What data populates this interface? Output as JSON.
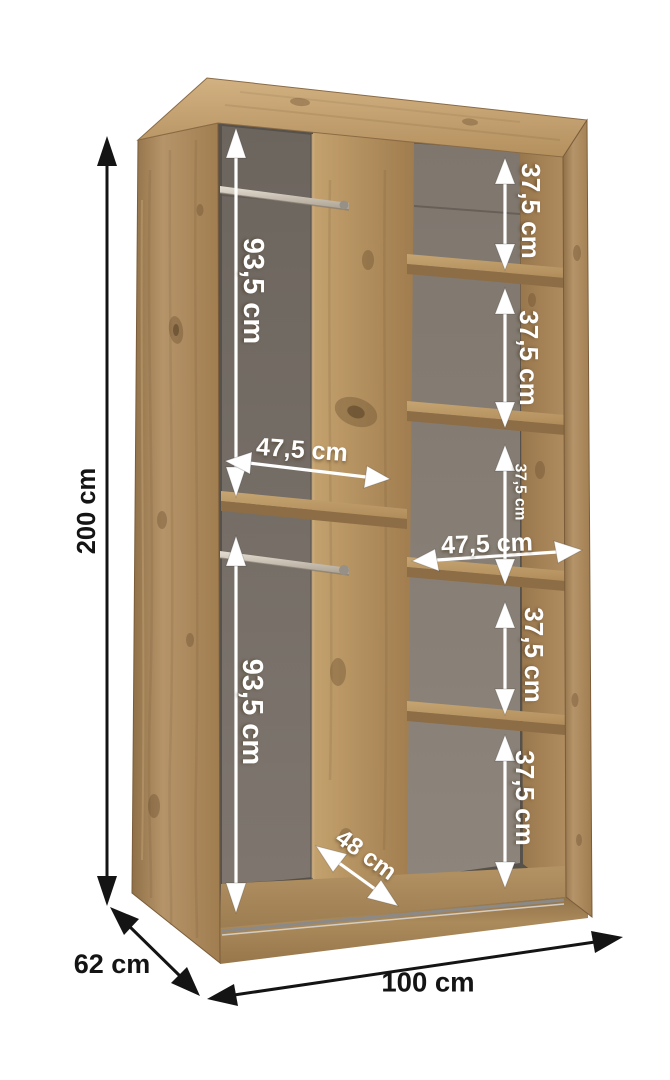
{
  "figure": {
    "kind": "Wardrobe interior dimensions diagram",
    "unit": "cm"
  },
  "labels": {
    "overall_height": "200 cm",
    "overall_width": "100 cm",
    "overall_depth": "62 cm",
    "top_hanging_height": "93,5 cm",
    "bottom_hanging_height": "93,5 cm",
    "left_section_width": "47,5 cm",
    "right_section_width": "47,5 cm",
    "usable_depth": "48 cm",
    "shelf_gaps": [
      "37,5 cm",
      "37,5 cm",
      "37,5 cm",
      "37,5 cm",
      "37,5 cm"
    ]
  },
  "colors": {
    "background": "#ffffff",
    "wood_light": "#cfae7e",
    "wood_mid": "#b2905f",
    "wood_dark": "#8a6b44",
    "back_wall_left": "#79716a",
    "back_wall_right": "#8a8178",
    "dimension_black": "#141414",
    "dimension_white": "#ffffff"
  }
}
